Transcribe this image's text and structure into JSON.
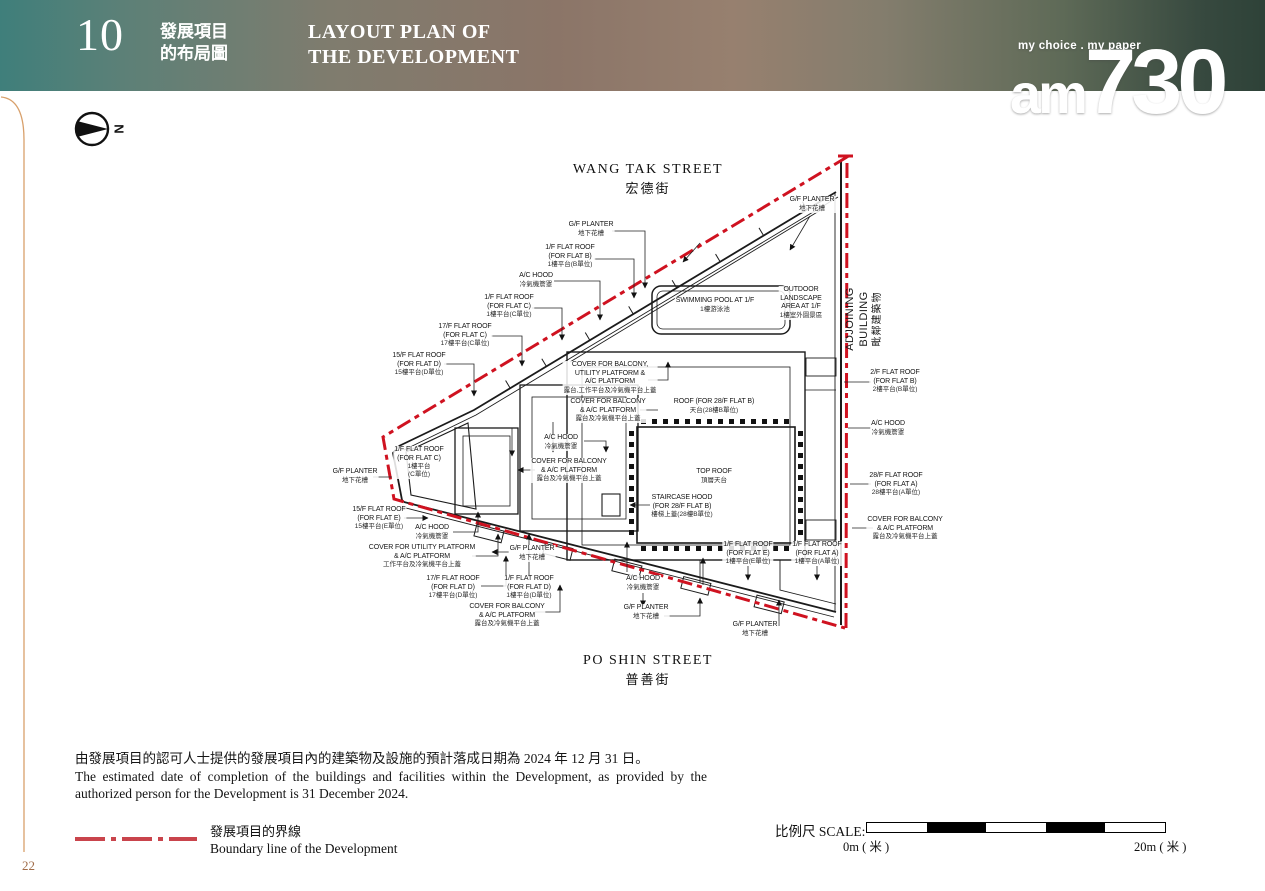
{
  "header": {
    "section_number": "10",
    "title_zh_line1": "發展項目",
    "title_zh_line2": "的布局圖",
    "title_en_line1": "LAYOUT PLAN OF",
    "title_en_line2": "THE DEVELOPMENT",
    "logo_tagline": "my choice . my paper",
    "logo_part1": "am",
    "logo_part2": "730"
  },
  "plan": {
    "north_letter": "N",
    "streets": {
      "top_en": "WANG TAK STREET",
      "top_zh": "宏德街",
      "bottom_en": "PO SHIN STREET",
      "bottom_zh": "普善街"
    },
    "adjoining_en": "ADJOINING BUILDING",
    "adjoining_zh": "毗鄰建築物",
    "labels": [
      {
        "id": "gf-planter-top",
        "lines": [
          "G/F PLANTER",
          "地下花槽"
        ]
      },
      {
        "id": "1f-flat-roof-b",
        "lines": [
          "1/F FLAT ROOF",
          "(FOR FLAT B)",
          "1樓平台(B單位)"
        ]
      },
      {
        "id": "ac-hood-upper-left",
        "lines": [
          "A/C HOOD",
          "冷氣機簷罩"
        ]
      },
      {
        "id": "1f-flat-roof-c",
        "lines": [
          "1/F FLAT ROOF",
          "(FOR FLAT C)",
          "1樓平台(C單位)"
        ]
      },
      {
        "id": "17f-flat-roof-c",
        "lines": [
          "17/F FLAT ROOF",
          "(FOR FLAT C)",
          "17樓平台(C單位)"
        ]
      },
      {
        "id": "15f-flat-roof-d",
        "lines": [
          "15/F FLAT ROOF",
          "(FOR FLAT D)",
          "15樓平台(D單位)"
        ]
      },
      {
        "id": "gf-planter-top-right",
        "lines": [
          "G/F PLANTER",
          "地下花槽"
        ]
      },
      {
        "id": "swimming-pool",
        "lines": [
          "SWIMMING POOL AT 1/F",
          "1樓游泳池"
        ]
      },
      {
        "id": "outdoor-landscape",
        "lines": [
          "OUTDOOR",
          "LANDSCAPE",
          "AREA AT 1/F",
          "1樓室外園景區"
        ]
      },
      {
        "id": "cover-balcony-utility-ac",
        "lines": [
          "COVER FOR BALCONY,",
          "UTILITY PLATFORM  &",
          "A/C PLATFORM",
          "露台,工作平台及冷氣機平台上蓋"
        ]
      },
      {
        "id": "cover-balcony-ac-mid",
        "lines": [
          "COVER FOR BALCONY",
          "& A/C PLATFORM",
          "露台及冷氣機平台上蓋"
        ]
      },
      {
        "id": "roof-28f-flat-b",
        "lines": [
          "ROOF (FOR 28/F FLAT B)",
          "天台(28樓B單位)"
        ]
      },
      {
        "id": "ac-hood-center",
        "lines": [
          "A/C HOOD",
          "冷氣機簷罩"
        ]
      },
      {
        "id": "cover-balcony-ac-left",
        "lines": [
          "COVER FOR BALCONY",
          "& A/C PLATFORM",
          "露台及冷氣機平台上蓋"
        ]
      },
      {
        "id": "top-roof",
        "lines": [
          "TOP ROOF",
          "頂層天台"
        ]
      },
      {
        "id": "staircase-hood",
        "lines": [
          "STAIRCASE HOOD",
          "(FOR 28/F FLAT B)",
          "樓梯上蓋(28樓B單位)"
        ]
      },
      {
        "id": "1f-flat-roof-c-inplan",
        "lines": [
          "1/F FLAT ROOF",
          "(FOR FLAT C)",
          "1樓平台",
          "(C單位)"
        ]
      },
      {
        "id": "gf-planter-left",
        "lines": [
          "G/F PLANTER",
          "地下花槽"
        ]
      },
      {
        "id": "15f-flat-roof-e",
        "lines": [
          "15/F FLAT ROOF",
          "(FOR FLAT E)",
          "15樓平台(E單位)"
        ]
      },
      {
        "id": "ac-hood-lower-left",
        "lines": [
          "A/C HOOD",
          "冷氣機簷罩"
        ]
      },
      {
        "id": "cover-utility-ac",
        "lines": [
          "COVER FOR UTILITY PLATFORM",
          "& A/C PLATFORM",
          "工作平台及冷氣機平台上蓋"
        ]
      },
      {
        "id": "gf-planter-mid",
        "lines": [
          "G/F PLANTER",
          "地下花槽"
        ]
      },
      {
        "id": "17f-flat-roof-d",
        "lines": [
          "17/F FLAT ROOF",
          "(FOR FLAT D)",
          "17樓平台(D單位)"
        ]
      },
      {
        "id": "1f-flat-roof-d",
        "lines": [
          "1/F FLAT ROOF",
          "(FOR FLAT D)",
          "1樓平台(D單位)"
        ]
      },
      {
        "id": "cover-balcony-ac-bottom",
        "lines": [
          "COVER FOR BALCONY",
          "& A/C PLATFORM",
          "露台及冷氣機平台上蓋"
        ]
      },
      {
        "id": "1f-flat-roof-e",
        "lines": [
          "1/F FLAT ROOF",
          "(FOR FLAT E)",
          "1樓平台(E單位)"
        ]
      },
      {
        "id": "1f-flat-roof-a",
        "lines": [
          "1/F FLAT ROOF",
          "(FOR FLAT A)",
          "1樓平台(A單位)"
        ]
      },
      {
        "id": "ac-hood-bottom",
        "lines": [
          "A/C HOOD",
          "冷氣機簷罩"
        ]
      },
      {
        "id": "gf-planter-bottom",
        "lines": [
          "G/F PLANTER",
          "地下花槽"
        ]
      },
      {
        "id": "gf-planter-bottom-right",
        "lines": [
          "G/F PLANTER",
          "地下花槽"
        ]
      },
      {
        "id": "2f-flat-roof-b",
        "lines": [
          "2/F FLAT ROOF",
          "(FOR FLAT B)",
          "2樓平台(B單位)"
        ]
      },
      {
        "id": "ac-hood-right",
        "lines": [
          "A/C HOOD",
          "冷氣機簷罩"
        ]
      },
      {
        "id": "28f-flat-roof-a",
        "lines": [
          "28/F FLAT ROOF",
          "(FOR FLAT A)",
          "28樓平台(A單位)"
        ]
      },
      {
        "id": "cover-balcony-ac-right",
        "lines": [
          "COVER FOR BALCONY",
          "& A/C PLATFORM",
          "露台及冷氣機平台上蓋"
        ]
      }
    ]
  },
  "notes": {
    "zh": "由發展項目的認可人士提供的發展項目內的建築物及設施的預計落成日期為 2024 年 12 月 31 日。",
    "en": "The estimated date of completion of the buildings and facilities within the Development, as provided by the authorized person for the Development is 31 December 2024."
  },
  "legend": {
    "zh": "發展項目的界線",
    "en": "Boundary line of the Development"
  },
  "scale": {
    "label_zh": "比例尺",
    "label_en": "SCALE:",
    "start_label": "0m ( 米 )",
    "end_label": "20m ( 米 )"
  },
  "page_number": "22",
  "colors": {
    "boundary_red": "#cf1220",
    "header_teal": "#3f7f7b",
    "header_green": "#2e4238",
    "accent_orange": "#d8a06b"
  }
}
